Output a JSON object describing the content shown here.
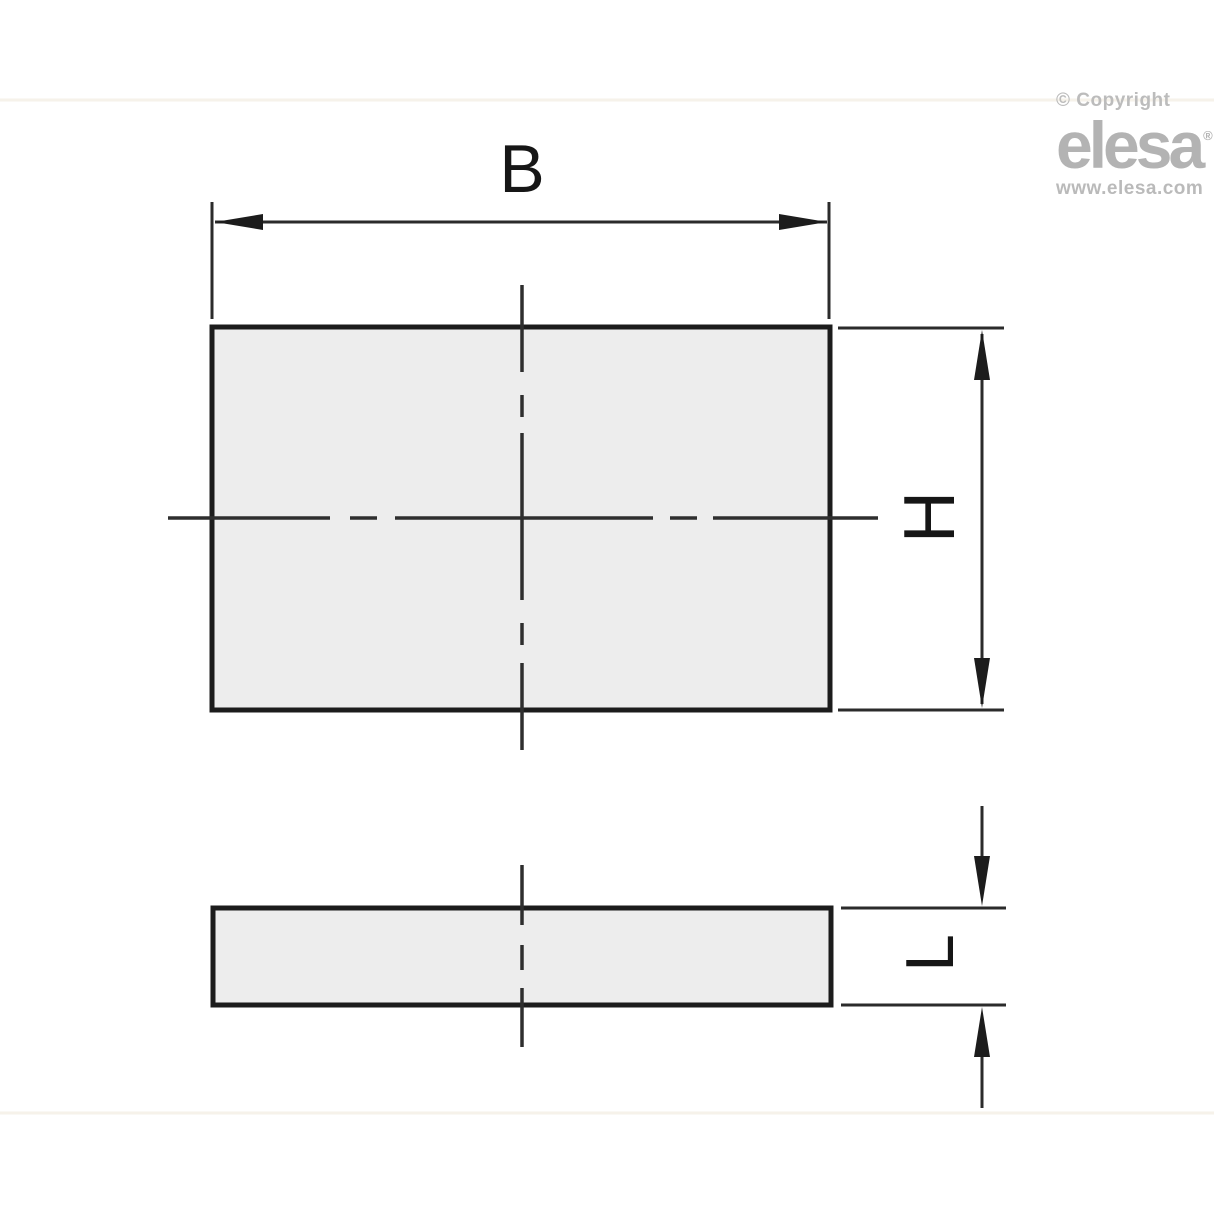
{
  "branding": {
    "copyright": "© Copyright",
    "logo_text": "elesa",
    "registered_mark": "®",
    "website": "www.elesa.com",
    "logo_color": "#b3b3b3"
  },
  "drawing": {
    "dimension_labels": {
      "width": "B",
      "height": "H",
      "thickness": "L"
    },
    "colors": {
      "object_line": "#1c1c1c",
      "dimension_line": "#2b2b2b",
      "centerline": "#2e2e2e",
      "part_fill": "#ededed",
      "background": "#ffffff"
    }
  }
}
